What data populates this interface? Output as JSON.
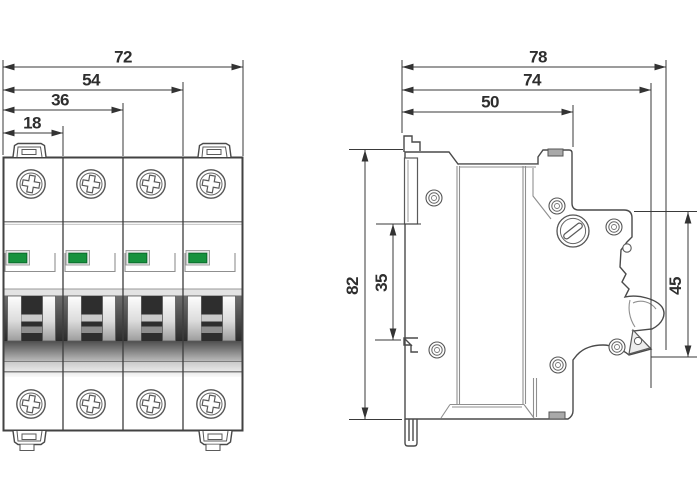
{
  "figure": {
    "kind": "technical-dimensional-drawing",
    "subject": "4-pole miniature circuit breaker",
    "views": [
      "front-view",
      "side-view"
    ]
  },
  "front_view": {
    "pole_count": 4,
    "dims": {
      "total_width": "72",
      "three_pole_width": "54",
      "two_pole_width": "36",
      "one_pole_width": "18"
    },
    "indicator_color": "#17923E"
  },
  "side_view": {
    "dims": {
      "overall_depth": "78",
      "body_depth": "74",
      "front_depth": "50",
      "overall_height": "82",
      "rail_recess_height": "35",
      "front_face_height": "45"
    }
  },
  "colors": {
    "background": "#FFFFFF",
    "outline": "#4A4A4A",
    "dimension_line": "#3A3A3A",
    "label_text": "#2E2E2E",
    "indicator_green": "#17923E",
    "indicator_green_border": "#0B6B2C",
    "toggle_dark": "#2D2D2D"
  }
}
